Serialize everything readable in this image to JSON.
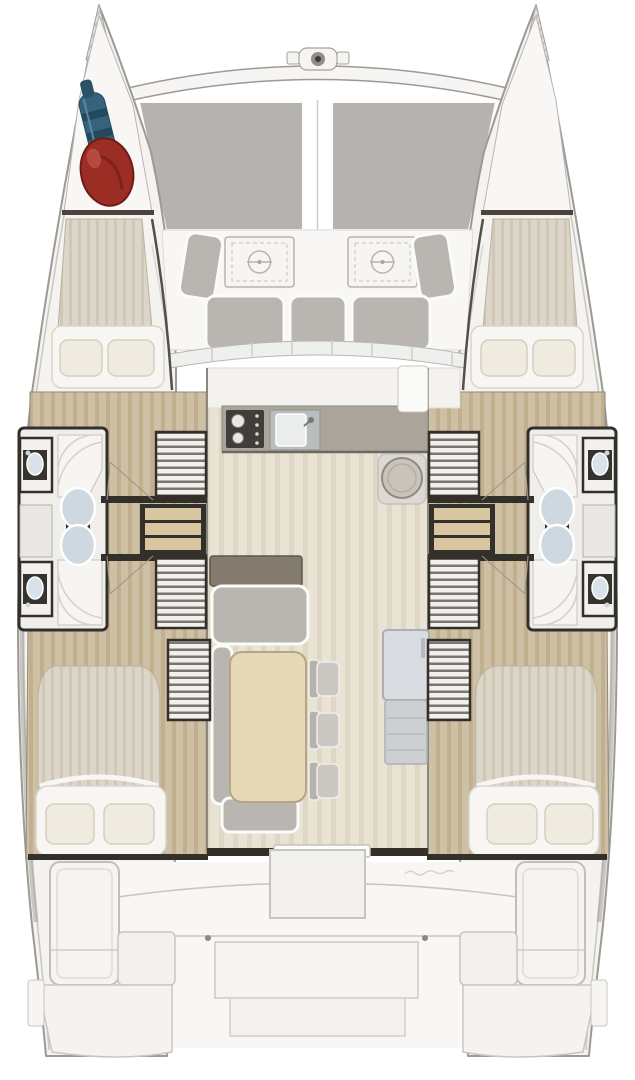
{
  "meta": {
    "title": "Catamaran interior layout plan (top view, bow up)",
    "cabins": 4,
    "bathrooms": 4,
    "view": "overhead floor plan"
  },
  "palette": {
    "page_bg": "#ffffff",
    "hull_fill": "#f4f3f0",
    "hull_stroke": "#9d9994",
    "gunwale": "#c9c6c1",
    "topsides": "#a8a29a",
    "dark_wall": "#332f29",
    "trampoline": "#b5b2af",
    "beam_fill": "#f6f5f3",
    "cushion": "#b9b5b1",
    "cushion_trim": "#fbfbfa",
    "hatch_fill": "#f6f5f3",
    "hatch_stroke": "#b7b4b0",
    "white_deck": "#f8f7f5",
    "window_band": "#eef0ee",
    "wood_base": "#cec0a4",
    "wood_stripe": "#c1af8e",
    "salon_floor_base": "#e9e3d4",
    "salon_floor_stripe": "#dfd7c5",
    "mattress_base": "#dcd6c8",
    "mattress_stripe": "#cfc8b6",
    "bed_frame": "#f8f6f2",
    "pillow": "#f0ebe0",
    "pillow_stroke": "#d5cfbf",
    "module_fill": "#f0eeeb",
    "shower_fill": "#f6f5f2",
    "toilet_fill": "#cdd8e0",
    "basin_fill": "#d9e2e8",
    "counter": "#aba49b",
    "stove": "#413e39",
    "sink": "#b9bdbd",
    "table": "#e7d8b6",
    "table_stroke": "#b3a585",
    "chair": "#b6b2ae",
    "chair_inner": "#cbc7c2",
    "sofa": "#b9b5b0",
    "sofa_cabinet": "#837b6d",
    "fridge": "#d9dce0",
    "fridge_stroke": "#abaeb3",
    "pouf": "#c9c3b9",
    "platform": "#dcd9d4",
    "steps_base": "#f1f0ed",
    "steps_stripe": "#7b766f",
    "tread": "#d8c6a1",
    "fender_red": "#9c2d24",
    "fender_dark": "#6b1c16",
    "sailbag_blue": "#35637e",
    "sailbag_dark": "#24495d",
    "aft_line": "#c7c5c1"
  },
  "legend": {
    "description": "4-cabin / 4-bathroom sailing catamaran accommodation plan",
    "zones": [
      {
        "name": "foredeck",
        "items": [
          "trampoline",
          "forward crossbeam",
          "forestay fitting",
          "port bow locker with sail bag and red fender",
          "starboard bow locker"
        ]
      },
      {
        "name": "forward-cockpit",
        "items": [
          "u-shaped bench seating",
          "two deck hatches"
        ]
      },
      {
        "name": "salon",
        "items": [
          "curved windshield",
          "galley counter with stove and sink",
          "round pouf seat",
          "dinette table with sofa and three chairs",
          "refrigerator unit",
          "aft sliding door"
        ]
      },
      {
        "name": "port-hull",
        "items": [
          "forward double berth",
          "two bathrooms with shower, toilet, washbasin",
          "companionway steps",
          "aft double berth"
        ]
      },
      {
        "name": "starboard-hull",
        "items": [
          "forward double berth",
          "two bathrooms with shower, toilet, washbasin",
          "companionway steps",
          "aft double berth"
        ]
      },
      {
        "name": "aft-deck",
        "items": [
          "cockpit benches",
          "transom platforms",
          "swim steps"
        ]
      }
    ]
  }
}
